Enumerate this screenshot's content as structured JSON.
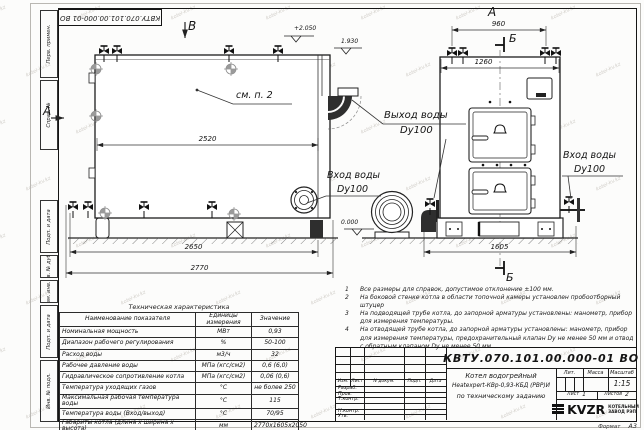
{
  "watermark": "kotel-kv.kz",
  "colors": {
    "ink": "#1c1c1c",
    "paper": "#fcfcfb",
    "watermark": "#968f84"
  },
  "icons": {
    "logo_mark": "three-bars",
    "valve": "gate-valve-symbol",
    "position_marker": "crosshair-circle",
    "elevation_mark": "chevron-flag"
  },
  "stamp_top": "КВТУ.070.101.00.000-01 ВО",
  "frame": {
    "left_labels": [
      "Перв. примен.",
      "Справ. №",
      "Подп. и дата",
      "Инв. № дубл.",
      "Взам. инв. №",
      "Подп. и дата",
      "Инв. № подл."
    ],
    "format_label": "Формат",
    "format_value": "А3"
  },
  "drawing": {
    "view_labels": {
      "v": "В",
      "a_top": "А",
      "a_side": "А",
      "b_top": "Б",
      "b_bottom": "Б"
    },
    "see_note": "см. п. 2",
    "elevations": {
      "top": "+2.050",
      "mid": "1.930",
      "ground": "0.000"
    },
    "dims": {
      "d2520": "2520",
      "d2650": "2650",
      "d2770": "2770",
      "d960": "960",
      "d1260": "1260",
      "d1605": "1605"
    },
    "labels": {
      "out_water_1": "Выход воды",
      "out_water_2": "Dy100",
      "in_water_left_1": "Вход воды",
      "in_water_left_2": "Dy100",
      "in_water_right_1": "Вход воды",
      "in_water_right_2": "Dy100"
    }
  },
  "notes": {
    "items": [
      {
        "n": "1",
        "text": "Все размеры для справок, допустимое отклонение ±100 мм."
      },
      {
        "n": "2",
        "text": "На боковой стенке котла в области топочной камеры установлен пробоотборный штуцер"
      },
      {
        "n": "3",
        "text": "На подводящей трубе котла, до запорной арматуры установлены: манометр, прибор для измерения температуры."
      },
      {
        "n": "4",
        "text": "На отводящей трубе котла, до запорной арматуры установлены: манометр, прибор для измерения температуры, предохранительный клапан Dу не менее 50 мм и отвод с обратным клапаном Dу не менее 50 мм."
      }
    ]
  },
  "spec_table": {
    "title": "Техническая характеристика",
    "headers": [
      "Наименование показателя",
      "Единицы измерения",
      "Значение"
    ],
    "rows": [
      [
        "Номинальная мощность",
        "МВт",
        "0,93"
      ],
      [
        "Диапазон рабочего регулирования",
        "%",
        "50-100"
      ],
      [
        "Расход воды",
        "м3/ч",
        "32"
      ],
      [
        "Рабочее давление воды",
        "МПа (кгс/см2)",
        "0,6 (6,0)"
      ],
      [
        "Гидравлическое сопротивление котла",
        "МПа (кгс/см2)",
        "0,06 (0,6)"
      ],
      [
        "Температура уходящих газов",
        "°С",
        "не более 250"
      ],
      [
        "Максимальная рабочая температура воды",
        "°С",
        "115"
      ],
      [
        "Температура воды (Вход/выход)",
        "°С",
        "70/95"
      ],
      [
        "Габариты котла (длина х ширина х высота)",
        "мм",
        "2770х1605х2050"
      ]
    ]
  },
  "title_block": {
    "doc_number": "КВТУ.070.101.00.000-01 ВО",
    "rev_headers": [
      "Изм.",
      "Лист",
      "N докум.",
      "Подп.",
      "Дата"
    ],
    "sign_rows": [
      "Разраб.",
      "Пров.",
      "Т.контр.",
      "",
      "Н.контр.",
      "Утв."
    ],
    "description": [
      "Котел водогрейный",
      "Heatexpert-КВр-0,93-КБД (РВР)И",
      "по техническому заданию"
    ],
    "lit_label": "Лит.",
    "mass_label": "Масса",
    "scale_label": "Масштаб",
    "scale_value": "1:15",
    "sheet_label": "Лист",
    "sheet_value": "1",
    "sheets_label": "Листов",
    "sheets_value": "2",
    "logo_text": "KVZR",
    "logo_sub_1": "КОТЕЛЬНЫЙ",
    "logo_sub_2": "ЗАВОД РЭП"
  }
}
